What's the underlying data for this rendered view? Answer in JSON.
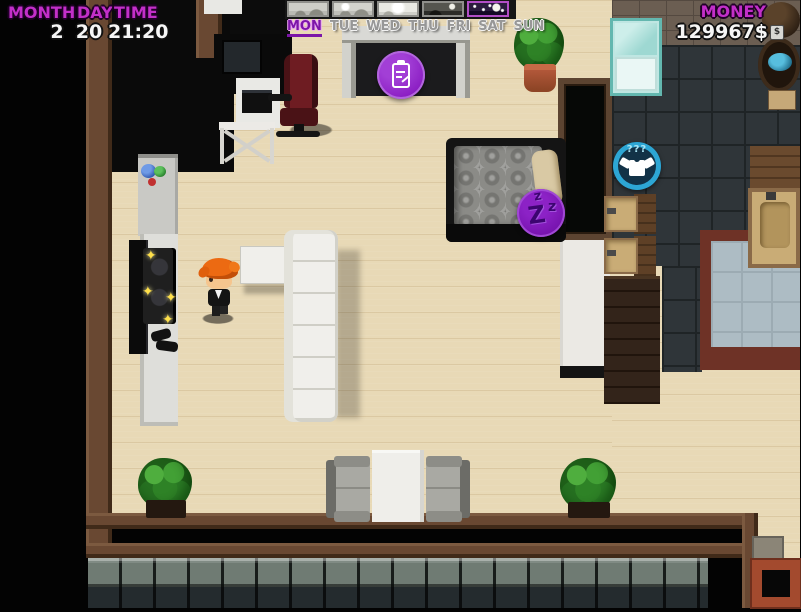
{
  "hud": {
    "month_label": "MONTH",
    "day_label": "DAY",
    "time_label": "TIME",
    "month_value": "2",
    "day_value": "20",
    "time_value": "21:20",
    "money_label": "MONEY",
    "money_value": "129967$"
  },
  "calendar": {
    "days": [
      {
        "label": "MON",
        "active": true
      },
      {
        "label": "TUE",
        "active": false
      },
      {
        "label": "WED",
        "active": false
      },
      {
        "label": "THU",
        "active": false
      },
      {
        "label": "FRI",
        "active": false
      },
      {
        "label": "SAT",
        "active": false
      },
      {
        "label": "SUN",
        "active": false
      }
    ],
    "weather_tiles": [
      "overcast",
      "overcast-sun",
      "sunny",
      "dusk-moon",
      "night-moon-stars"
    ]
  },
  "buttons": {
    "sleep": {
      "z_small_1": "z",
      "z_big": "Z",
      "z_small_2": "z"
    },
    "wardrobe": {
      "label": "???"
    }
  },
  "icons": {
    "sparkle": "✦",
    "money_badge": "$"
  },
  "colors": {
    "accent_magenta": "#c32fc9",
    "button_purple": "#8a1cc2",
    "button_cyan": "#2da6d4",
    "day_active": "#7c15a8"
  }
}
